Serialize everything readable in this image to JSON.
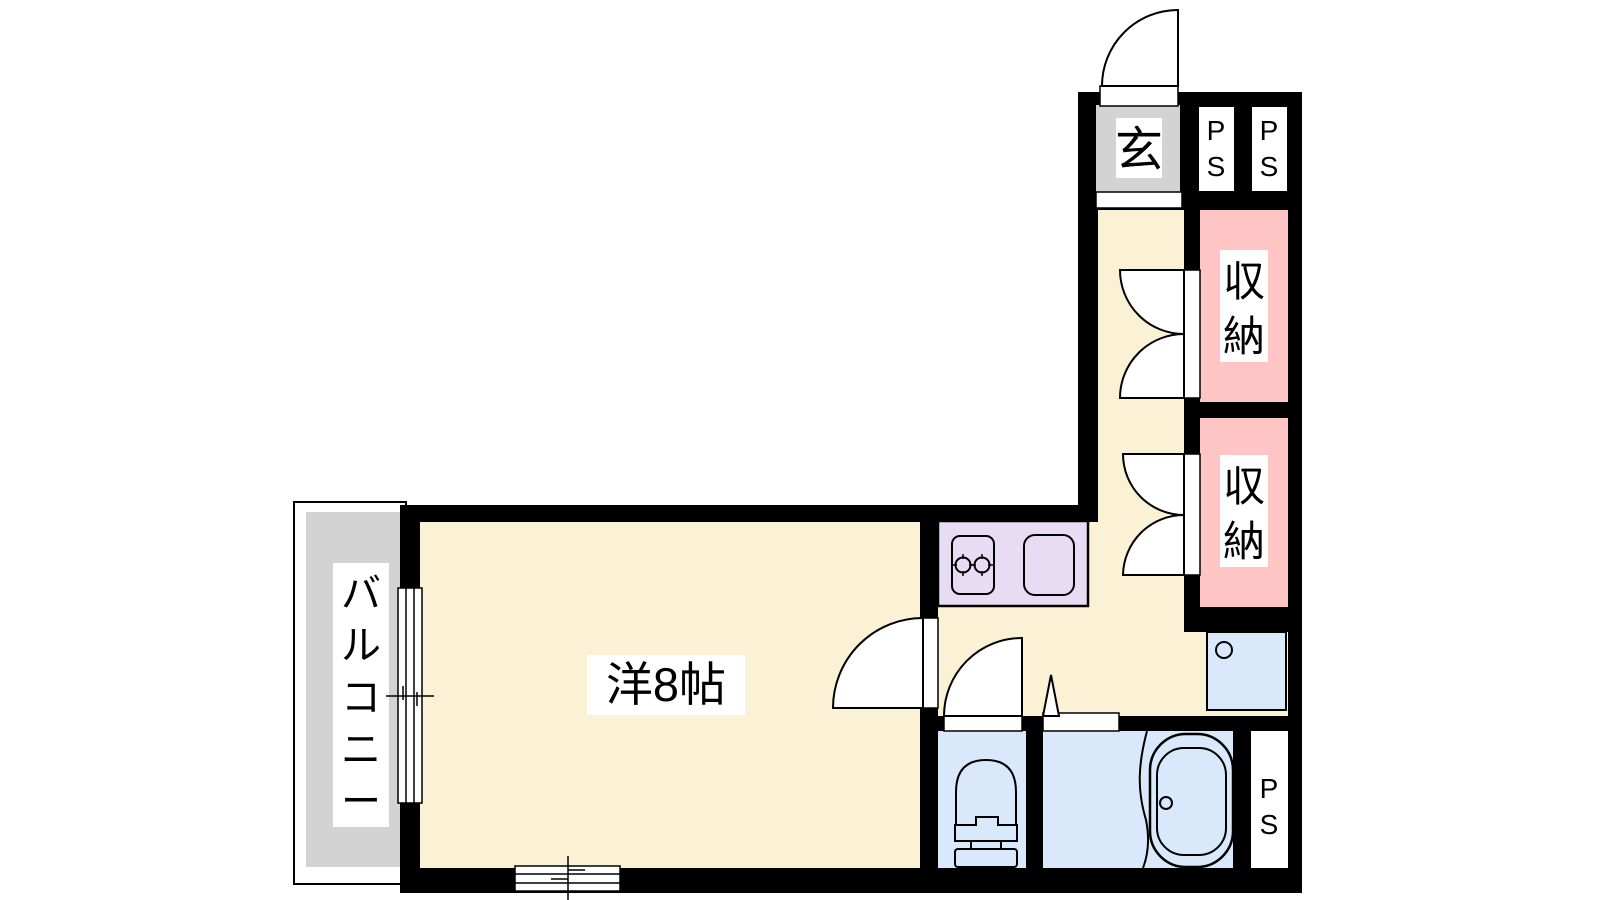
{
  "title": "apartment-floor-plan-1K",
  "colors": {
    "wall": "#000000",
    "floor_cream": "#FBF2D5",
    "storage_pink": "#FFC4C4",
    "kitchen_lavender": "#E8DCF4",
    "bath_blue": "#D9E8FA",
    "balcony_gray": "#D3D3D3",
    "background": "#FFFFFF"
  },
  "rooms": {
    "main_room": {
      "label": "洋8帖"
    },
    "balcony": {
      "label": "バルコニー",
      "chars": [
        "バ",
        "ル",
        "コ",
        "ニ",
        "ー"
      ]
    },
    "entrance": {
      "label": "玄"
    },
    "storage_upper": {
      "label": "収納",
      "chars": [
        "収",
        "納"
      ]
    },
    "storage_lower": {
      "label": "収納",
      "chars": [
        "収",
        "納"
      ]
    },
    "pipe_space_top_left": {
      "label": "PS",
      "chars": [
        "P",
        "S"
      ]
    },
    "pipe_space_top_right": {
      "label": "PS",
      "chars": [
        "P",
        "S"
      ]
    },
    "pipe_space_bottom": {
      "label": "PS",
      "chars": [
        "P",
        "S"
      ]
    }
  },
  "fixtures": [
    "entrance-swing-door",
    "storage-double-doors-upper",
    "storage-double-doors-lower",
    "kitchen-counter",
    "stove-two-burner",
    "kitchen-sink",
    "room-swing-door",
    "toilet-swing-door",
    "bath-folding-door",
    "toilet",
    "bathtub",
    "washbasin",
    "balcony-sliding-window",
    "south-sliding-window"
  ]
}
